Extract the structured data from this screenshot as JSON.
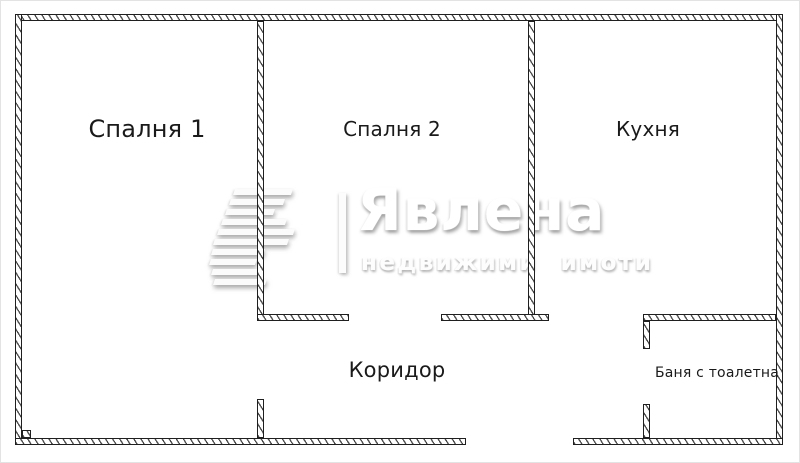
{
  "logo": {
    "brand": "Явлена",
    "tagline": "недвижими имоти",
    "icon": "yavlena-stripes-icon"
  },
  "colors": {
    "background": "#ffffff",
    "wall_line": "#1f1f1f",
    "label_text": "#1a1a1a",
    "watermark_gray": "#d9d9d9"
  },
  "floorplan": {
    "rooms": [
      {
        "id": "bedroom-1",
        "label": "Спалня 1",
        "cx": 146,
        "cy": 128,
        "size": 24
      },
      {
        "id": "bedroom-2",
        "label": "Спалня 2",
        "cx": 391,
        "cy": 128,
        "size": 20
      },
      {
        "id": "kitchen",
        "label": "Кухня",
        "cx": 647,
        "cy": 128,
        "size": 20
      },
      {
        "id": "corridor",
        "label": "Коридор",
        "cx": 396,
        "cy": 369,
        "size": 21
      },
      {
        "id": "bathroom",
        "label": "Баня с тоалетна",
        "cx": 716,
        "cy": 372,
        "size": 14
      }
    ],
    "walls": [
      {
        "name": "outer-top",
        "x": 14,
        "y": 13,
        "w": 768,
        "h": 7
      },
      {
        "name": "outer-left",
        "x": 14,
        "y": 13,
        "w": 7,
        "h": 431
      },
      {
        "name": "outer-right",
        "x": 775,
        "y": 13,
        "w": 7,
        "h": 431
      },
      {
        "name": "outer-bottom-west",
        "x": 14,
        "y": 437,
        "w": 451,
        "h": 7
      },
      {
        "name": "outer-bottom-east",
        "x": 572,
        "y": 437,
        "w": 210,
        "h": 7
      },
      {
        "name": "bedroom1-bedroom2-divider",
        "x": 256,
        "y": 20,
        "w": 7,
        "h": 300
      },
      {
        "name": "bedroom2-south-arm-west",
        "x": 256,
        "y": 313,
        "w": 92,
        "h": 7
      },
      {
        "name": "bedroom1-corridor-stub",
        "x": 256,
        "y": 398,
        "w": 7,
        "h": 39
      },
      {
        "name": "bedroom2-kitchen-divider",
        "x": 527,
        "y": 20,
        "w": 7,
        "h": 300
      },
      {
        "name": "bedroom2-south-arm-east",
        "x": 440,
        "y": 313,
        "w": 108,
        "h": 7
      },
      {
        "name": "bathroom-north-wall",
        "x": 642,
        "y": 313,
        "w": 133,
        "h": 7
      },
      {
        "name": "bathroom-west-stub-upper",
        "x": 642,
        "y": 320,
        "w": 7,
        "h": 28
      },
      {
        "name": "bathroom-west-stub-lower",
        "x": 642,
        "y": 403,
        "w": 7,
        "h": 34
      },
      {
        "name": "entry-corner-step",
        "x": 21,
        "y": 429,
        "w": 9,
        "h": 8
      }
    ]
  }
}
